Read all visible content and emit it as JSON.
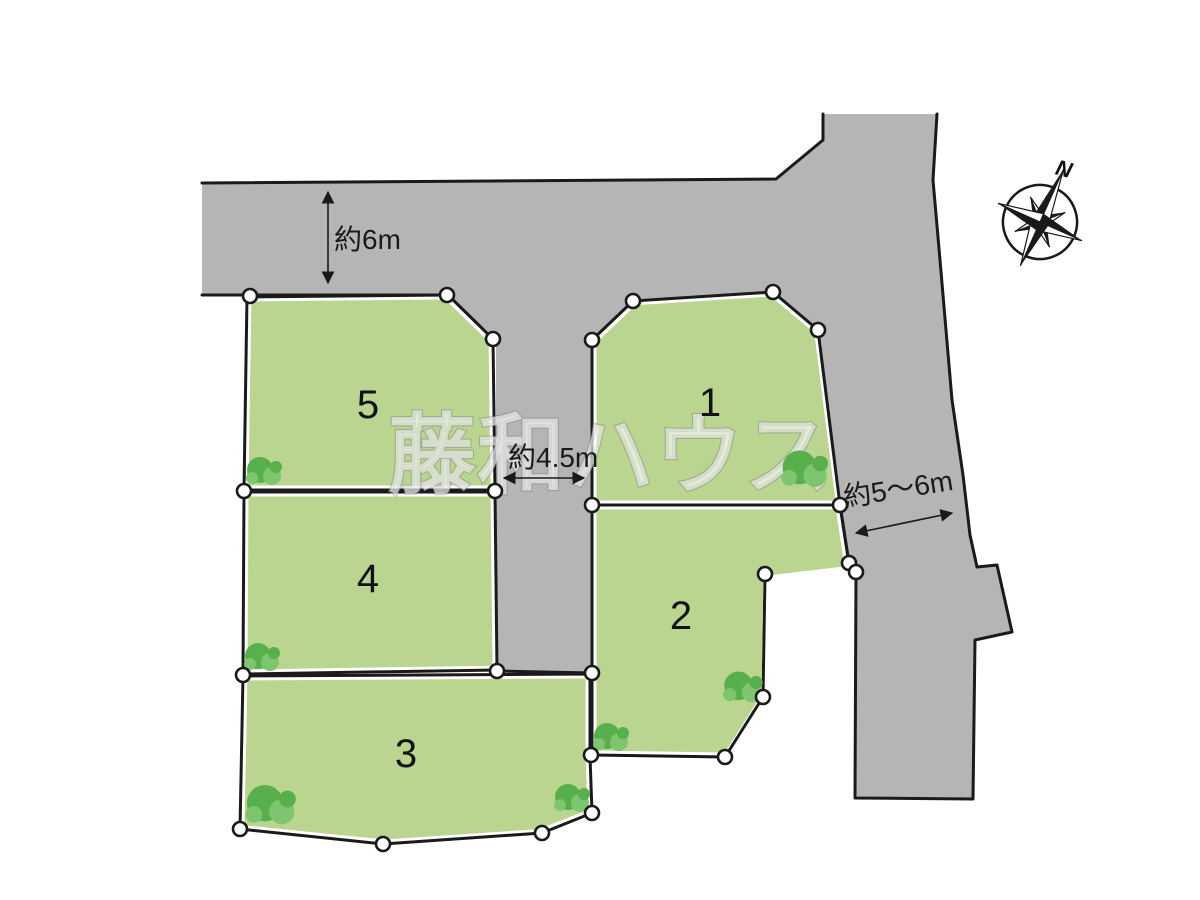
{
  "colors": {
    "background": "#ffffff",
    "road": "#b5b5b5",
    "outline": "#1a1a1a",
    "lot_fill": "#b9d58f",
    "lot_border_gap": "#ffffff",
    "marker_fill": "#ffffff",
    "tree_dark": "#57b04c",
    "tree_light": "#7dc56e"
  },
  "watermark": {
    "text": "藤和ハウス",
    "x": 388,
    "y": 486,
    "font_size": 88
  },
  "compass": {
    "label": "N",
    "cx": 1040,
    "cy": 222,
    "radius": 37,
    "rotation": 24,
    "label_x": 1062,
    "label_y": 176,
    "label_rotate": 15
  },
  "roads": {
    "fill_points": "202,183 776,179 823,140 823,114 937,114 933,180 940,260 952,400 963,475 970,535 977,567 997,565 1012,632 975,640 973,799 855,798 856,572 849,563 840,505 592,505 592,673 496,671 496,339 448,295 202,295",
    "stroke_paths": [
      [
        [
          202,
          183
        ],
        [
          776,
          179
        ],
        [
          823,
          140
        ],
        [
          823,
          114
        ]
      ],
      [
        [
          937,
          114
        ],
        [
          933,
          180
        ],
        [
          940,
          260
        ],
        [
          952,
          400
        ],
        [
          963,
          475
        ],
        [
          970,
          535
        ],
        [
          977,
          567
        ],
        [
          997,
          565
        ],
        [
          1012,
          632
        ],
        [
          975,
          640
        ],
        [
          973,
          799
        ],
        [
          855,
          798
        ],
        [
          856,
          572
        ],
        [
          849,
          563
        ],
        [
          840,
          505
        ]
      ],
      [
        [
          202,
          295
        ],
        [
          448,
          295
        ]
      ],
      [
        [
          496,
          671
        ],
        [
          592,
          673
        ]
      ]
    ]
  },
  "lots": [
    {
      "label": "1",
      "points": [
        [
          633,
          301
        ],
        [
          773,
          292
        ],
        [
          818,
          330
        ],
        [
          840,
          505
        ],
        [
          592,
          505
        ],
        [
          592,
          340
        ]
      ],
      "label_x": 710,
      "label_y": 416
    },
    {
      "label": "2",
      "points": [
        [
          592,
          505
        ],
        [
          840,
          505
        ],
        [
          849,
          564
        ],
        [
          765,
          574
        ],
        [
          763,
          697
        ],
        [
          725,
          757
        ],
        [
          592,
          755
        ]
      ],
      "label_x": 681,
      "label_y": 629
    },
    {
      "label": "3",
      "points": [
        [
          243,
          676
        ],
        [
          590,
          674
        ],
        [
          590,
          756
        ],
        [
          592,
          813
        ],
        [
          542,
          833
        ],
        [
          383,
          844
        ],
        [
          240,
          829
        ]
      ],
      "label_x": 406,
      "label_y": 767
    },
    {
      "label": "4",
      "points": [
        [
          244,
          492
        ],
        [
          495,
          492
        ],
        [
          497,
          670
        ],
        [
          243,
          674
        ]
      ],
      "label_x": 368,
      "label_y": 592
    },
    {
      "label": "5",
      "points": [
        [
          247,
          297
        ],
        [
          448,
          295
        ],
        [
          493,
          339
        ],
        [
          495,
          490
        ],
        [
          244,
          490
        ]
      ],
      "label_x": 368,
      "label_y": 418
    }
  ],
  "markers": [
    [
      250,
      296
    ],
    [
      447,
      295
    ],
    [
      493,
      339
    ],
    [
      244,
      491
    ],
    [
      495,
      491
    ],
    [
      243,
      675
    ],
    [
      497,
      671
    ],
    [
      592,
      673
    ],
    [
      633,
      301
    ],
    [
      773,
      292
    ],
    [
      818,
      330
    ],
    [
      592,
      340
    ],
    [
      592,
      505
    ],
    [
      840,
      505
    ],
    [
      849,
      563
    ],
    [
      856,
      572
    ],
    [
      765,
      574
    ],
    [
      763,
      697
    ],
    [
      725,
      757
    ],
    [
      591,
      755
    ],
    [
      592,
      813
    ],
    [
      542,
      833
    ],
    [
      383,
      844
    ],
    [
      240,
      829
    ]
  ],
  "trees": [
    {
      "x": 265,
      "y": 472,
      "s": 1.0
    },
    {
      "x": 263,
      "y": 658,
      "s": 1.0
    },
    {
      "x": 272,
      "y": 806,
      "s": 1.4
    },
    {
      "x": 573,
      "y": 799,
      "s": 1.0
    },
    {
      "x": 612,
      "y": 738,
      "s": 1.0
    },
    {
      "x": 744,
      "y": 688,
      "s": 1.1
    },
    {
      "x": 806,
      "y": 470,
      "s": 1.3
    }
  ],
  "dimensions": [
    {
      "id": "top-road",
      "text": "約6m",
      "x": 334,
      "y": 249,
      "font": 30,
      "rotate": 0,
      "arrow": {
        "x1": 328,
        "y1": 192,
        "x2": 328,
        "y2": 283
      }
    },
    {
      "id": "center-road",
      "text": "約4.5m",
      "x": 508,
      "y": 467,
      "font": 19,
      "rotate": 0,
      "arrow": {
        "x1": 504,
        "y1": 478,
        "x2": 584,
        "y2": 478
      }
    },
    {
      "id": "right-road",
      "text": "約5～6m",
      "x": 845,
      "y": 507,
      "font": 23,
      "rotate": -9,
      "arrow": {
        "x1": 856,
        "y1": 533,
        "x2": 952,
        "y2": 513
      }
    }
  ]
}
